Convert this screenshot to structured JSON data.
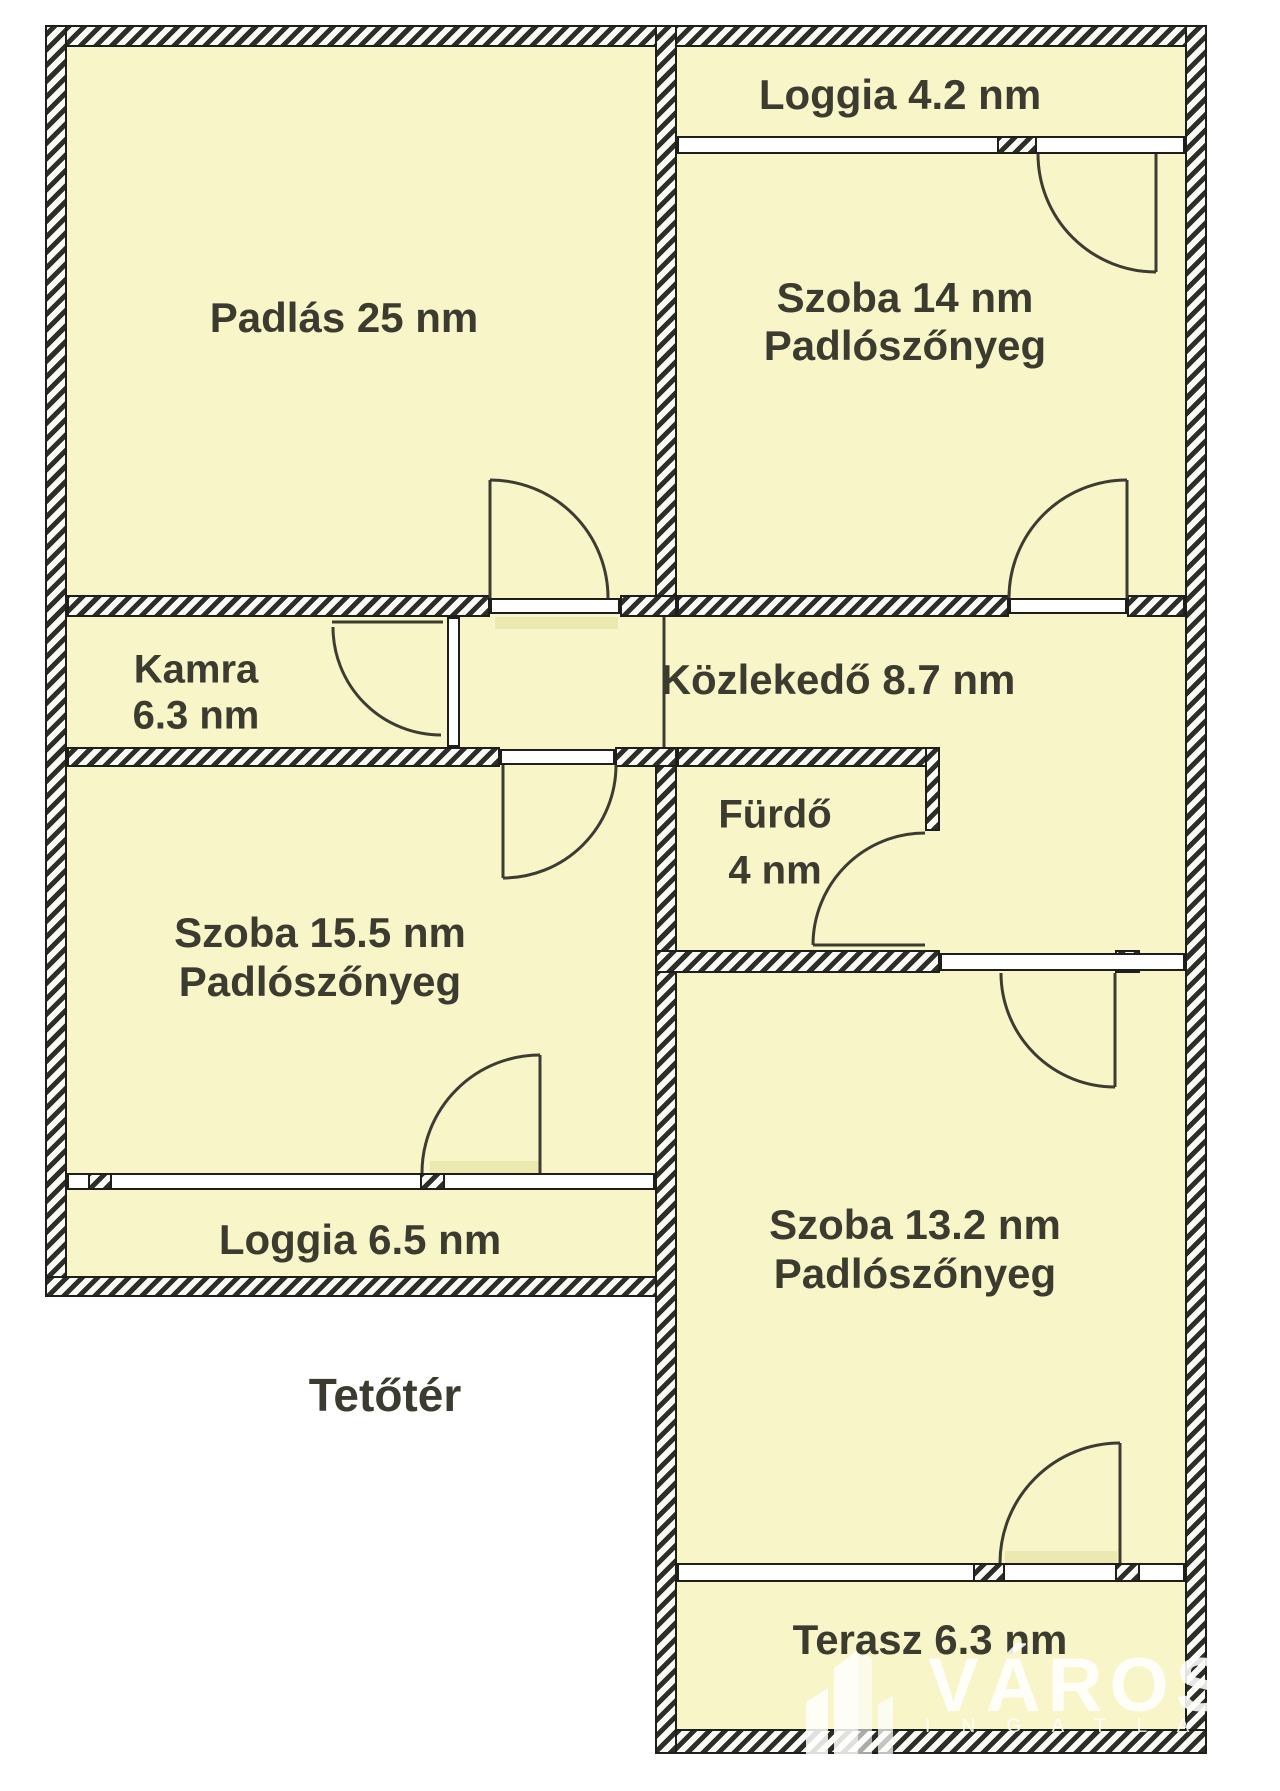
{
  "floor": {
    "label": "Tetőtér"
  },
  "rooms": {
    "padlas": {
      "label": "Padlás 25 nm"
    },
    "loggia_top": {
      "label": "Loggia 4.2 nm"
    },
    "szoba14": {
      "line1": "Szoba 14 nm",
      "line2": "Padlószőnyeg"
    },
    "kamra": {
      "line1": "Kamra",
      "line2": "6.3 nm"
    },
    "kozlekedo": {
      "label": "Közlekedő 8.7 nm"
    },
    "furdo": {
      "line1": "Fürdő",
      "line2": "4 nm"
    },
    "szoba155": {
      "line1": "Szoba 15.5 nm",
      "line2": "Padlószőnyeg"
    },
    "loggia_left": {
      "label": "Loggia 6.5 nm"
    },
    "szoba132": {
      "line1": "Szoba 13.2 nm",
      "line2": "Padlószőnyeg"
    },
    "terasz": {
      "label": "Terasz 6.3 nm"
    }
  },
  "watermark": {
    "brand": "VÁROS",
    "subtitle": "I N G A T L A N I R O D"
  },
  "colors": {
    "room_fill": "#f8f5c8",
    "wall_hatch": "#2e2e28",
    "outline": "#1e1e1a",
    "label_text": "#3b3b2f",
    "watermark": "#ffffff"
  }
}
